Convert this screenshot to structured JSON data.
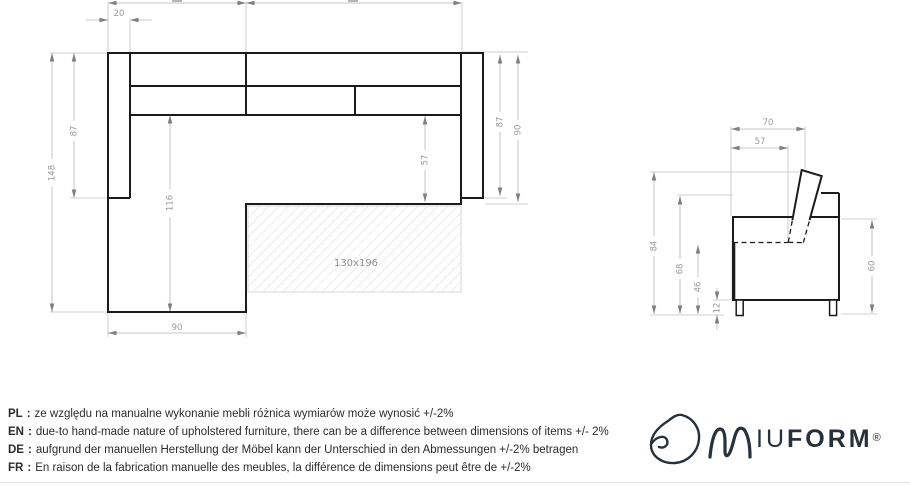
{
  "top_view": {
    "dims": {
      "armrest_width": "20",
      "total_depth": "148",
      "armrest_length_left": "87",
      "chaise_seat_length": "116",
      "chaise_width": "90",
      "seat_depth": "57",
      "armrest_length_right": "87",
      "side_depth_right": "90"
    },
    "bed_area_label": "130x196"
  },
  "side_view": {
    "dims": {
      "top_depth": "70",
      "seat_depth": "57",
      "total_height": "84",
      "back_height": "68",
      "seat_height": "46",
      "leg_height": "12",
      "side_height": "60"
    }
  },
  "notes": [
    {
      "lang": "PL",
      "text": "ze względu na manualne wykonanie mebli różnica wymiarów może wynosić +/-2%"
    },
    {
      "lang": "EN",
      "text": "due-to hand-made nature of upholstered furniture, there can be a difference between dimensions of items +/- 2%"
    },
    {
      "lang": "DE",
      "text": "aufgrund der manuellen Herstellung der Möbel kann der Unterschied in den Abmessungen +/-2% betragen"
    },
    {
      "lang": "FR",
      "text": "En raison de la fabrication manuelle des meubles, la différence de dimensions peut être de +/-2%"
    }
  ],
  "note_separator": ":",
  "logo": {
    "wordmark": "IUFORM",
    "registered": "®"
  },
  "colors": {
    "outline": "#1b1b1b",
    "dimension": "#b5b5b5",
    "dim_text": "#9a9a9a",
    "brand": "#28303b"
  }
}
